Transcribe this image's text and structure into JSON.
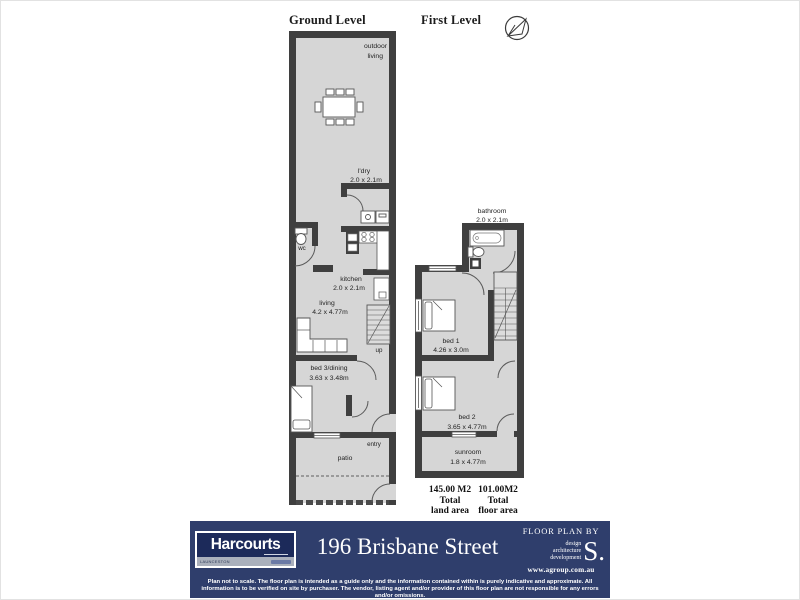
{
  "titles": {
    "ground": "Ground Level",
    "first": "First Level"
  },
  "ground": {
    "outdoor_line1": "outdoor",
    "outdoor_line2": "living",
    "laundry_name": "l'dry",
    "laundry_dims": "2.0 x 2.1m",
    "wc": "wc",
    "kitchen_name": "kitchen",
    "kitchen_dims": "2.0 x 2.1m",
    "living_name": "living",
    "living_dims": "4.2 x 4.77m",
    "up": "up",
    "bed3_name": "bed 3/dining",
    "bed3_dims": "3.63 x 3.48m",
    "entry": "entry",
    "patio": "patio"
  },
  "first": {
    "bathroom_name": "bathroom",
    "bathroom_dims": "2.0 x 2.1m",
    "bed1_name": "bed 1",
    "bed1_dims": "4.26 x 3.0m",
    "bed2_name": "bed 2",
    "bed2_dims": "3.65 x 4.77m",
    "sunroom_name": "sunroom",
    "sunroom_dims": "1.8 x 4.77m"
  },
  "areas": {
    "land_value": "145.00 M2",
    "land_line2": "Total",
    "land_line3": "land area",
    "floor_value": "101.00M2",
    "floor_line2": "Total",
    "floor_line3": "floor area"
  },
  "footer": {
    "brand": "Harcourts",
    "brand_location": "LAUNCESTON",
    "address": "196 Brisbane Street",
    "floor_plan_by": "FLOOR PLAN BY",
    "designer_lines": [
      "design",
      "architecture",
      "development"
    ],
    "designer_initial": "S.",
    "website": "www.agroup.com.au",
    "disclaimer": "Plan not to scale. The floor plan is intended as a guide only and the information contained within is purely indicative and approximate. All information is to be verified on site by purchaser. The vendor, listing agent and/or provider of this floor plan are not responsible for any errors and/or omissions."
  },
  "colors": {
    "wall": "#3f3f3f",
    "floor_fill": "#d6d6d6",
    "footer_navy": "#2f3e6c",
    "logo_navy": "#1c2a5a",
    "logo_band": "#aab0bc"
  }
}
